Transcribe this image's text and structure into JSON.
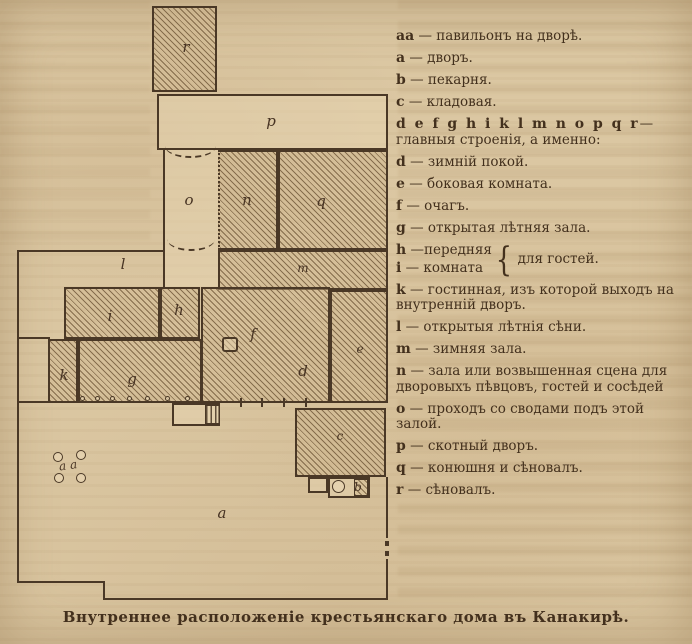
{
  "page": {
    "caption": "Внутреннее расположеніе крестьянскаго дома въ Канакирѣ."
  },
  "plan": {
    "labels": {
      "r": "r",
      "p": "p",
      "o": "o",
      "n": "n",
      "q": "q",
      "m": "m",
      "l": "l",
      "i": "i",
      "h": "h",
      "k": "k",
      "g": "g",
      "f": "f",
      "d": "d",
      "e": "e",
      "c": "c",
      "b": "b",
      "a": "a",
      "aa": "aa"
    }
  },
  "legend": {
    "items": [
      {
        "key": "аа",
        "text": "— павильонъ на дворѣ."
      },
      {
        "key": "а",
        "text": "— дворъ."
      },
      {
        "key": "b",
        "text": "— пекарня."
      },
      {
        "key": "c",
        "text": "— кладовая."
      },
      {
        "key": "d e f g h i k l m  n o  p q r",
        "text": "—главныя строенія, а именно:"
      },
      {
        "key": "d",
        "text": "— зимній покой."
      },
      {
        "key": "e",
        "text": "— боковая комната."
      },
      {
        "key": "f",
        "text": "— очагъ."
      },
      {
        "key": "g",
        "text": "— открытая лѣтняя зала."
      },
      {
        "key": "k",
        "text": "— гостинная, изъ которой выходъ на внутренній дворъ."
      },
      {
        "key": "l",
        "text": "— открытыя лѣтнія сѣни."
      },
      {
        "key": "m",
        "text": "— зимняя зала."
      },
      {
        "key": "n",
        "text": "— зала или возвышенная сцена для дворовыхъ пѣвцовъ, гостей и сосѣдей"
      },
      {
        "key": "o",
        "text": "— проходъ со сводами подъ этой залой."
      },
      {
        "key": "p",
        "text": "— скотный дворъ."
      },
      {
        "key": "q",
        "text": "— конюшня и сѣновалъ."
      },
      {
        "key": "r",
        "text": "— сѣновалъ."
      }
    ],
    "brace": {
      "h_key": "h",
      "h_text": "—передняя",
      "i_key": "i",
      "i_text": "— комната",
      "glyph": "{",
      "shared": "для гостей."
    }
  }
}
